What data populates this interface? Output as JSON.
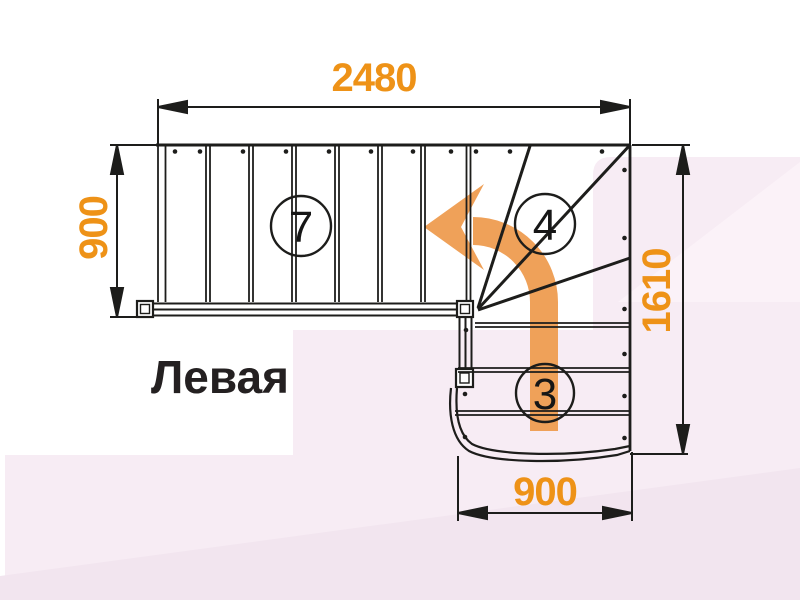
{
  "diagram": {
    "title": "Левая",
    "dimensions": {
      "top_width": "2480",
      "left_flight_width": "900",
      "right_depth": "1610",
      "bottom_flight_width": "900"
    },
    "step_labels": {
      "upper_flight": "7",
      "winder_steps": "4",
      "lower_flight": "3"
    },
    "colors": {
      "dimension_orange": "#EE9217",
      "arrow_orange": "#EFA159",
      "line_black": "#1D1D1B",
      "background_pink": "#F7ECF4",
      "background_pink_deep": "#F2E5EF",
      "title_black": "#242021"
    }
  }
}
